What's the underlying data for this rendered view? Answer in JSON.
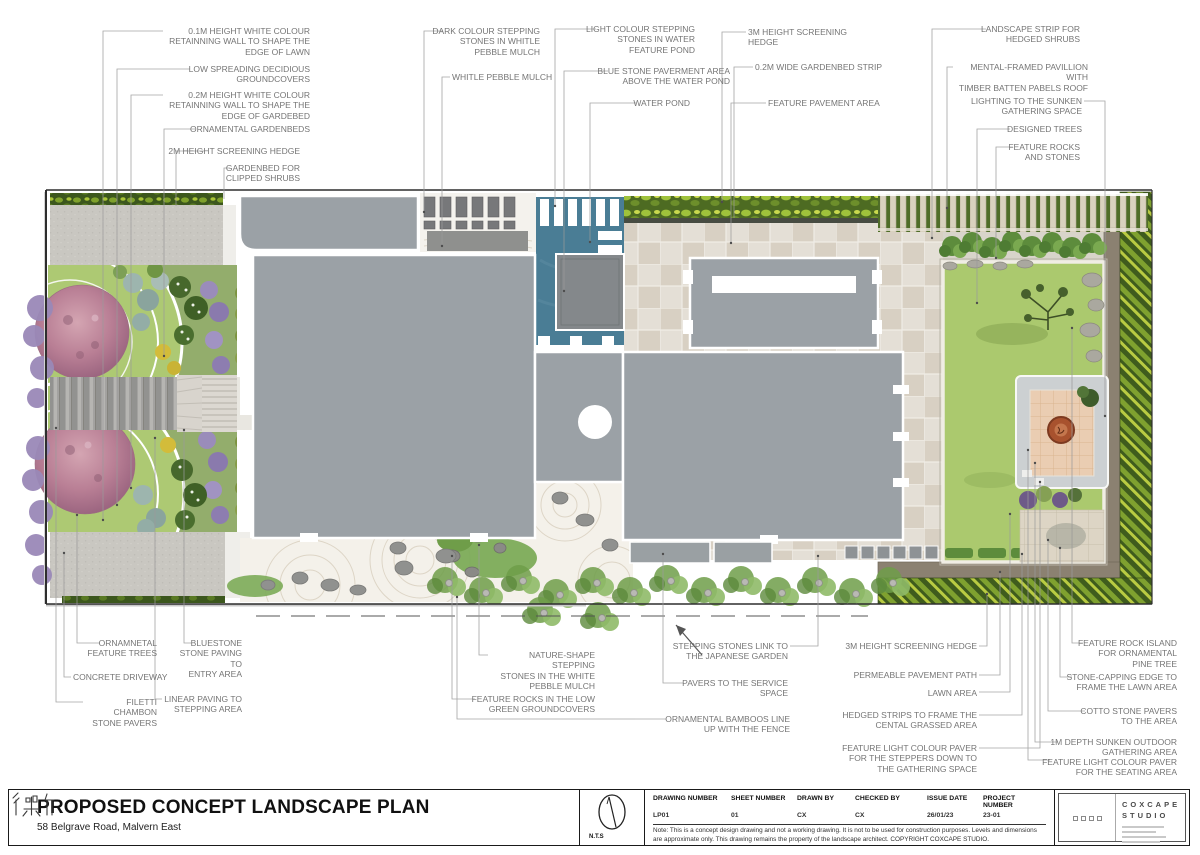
{
  "callouts": {
    "c1": {
      "text": "0.1M HEIGHT WHITE COLOUR\nRETAINNING WALL TO SHAPE THE\nEDGE OF LAWN"
    },
    "c2": {
      "text": "LOW SPREADING DECIDIOUS\nGROUNDCOVERS"
    },
    "c3": {
      "text": "0.2M HEIGHT WHITE COLOUR\nRETAINNING WALL TO SHAPE THE\nEDGE OF GARDEBED"
    },
    "c4": {
      "text": "ORNAMENTAL GARDENBEDS"
    },
    "c5": {
      "text": "2M HEIGHT SCREENING HEDGE"
    },
    "c6": {
      "text": "GARDENBED FOR\nCLIPPED SHRUBS"
    },
    "c7": {
      "text": "DARK COLOUR STEPPING\nSTONES IN WHITLE\nPEBBLE MULCH"
    },
    "c8": {
      "text": "WHITLE PEBBLE MULCH"
    },
    "c9": {
      "text": "LIGHT COLOUR STEPPING\nSTONES IN WATER\nFEATURE POND"
    },
    "c10": {
      "text": "BLUE STONE PAVERMENT AREA\nABOVE THE WATER POND"
    },
    "c11": {
      "text": "WATER POND"
    },
    "c12": {
      "text": "3M HEIGHT SCREENING HEDGE"
    },
    "c13": {
      "text": "0.2M WIDE GARDENBED STRIP"
    },
    "c14": {
      "text": "FEATURE PAVEMENT AREA"
    },
    "c15": {
      "text": "LANDSCAPE STRIP FOR\nHEDGED SHRUBS"
    },
    "c16": {
      "text": "MENTAL-FRAMED PAVILLION WITH\nTIMBER BATTEN PABELS ROOF"
    },
    "c17": {
      "text": "LIGHTING TO THE SUNKEN\nGATHERING SPACE"
    },
    "c18": {
      "text": "DESIGNED TREES"
    },
    "c19": {
      "text": "FEATURE ROCKS\nAND STONES"
    },
    "c20": {
      "text": "ORNAMNETAL\nFEATURE TREES"
    },
    "c21": {
      "text": "CONCRETE DRIVEWAY"
    },
    "c22": {
      "text": "FILETTI CHAMBON\nSTONE PAVERS"
    },
    "c23": {
      "text": "BLUESTONE\nSTONE PAVING TO\nENTRY AREA"
    },
    "c24": {
      "text": "LINEAR PAVING TO\nSTEPPING AREA"
    },
    "c25": {
      "text": "NATURE-SHAPE STEPPING\nSTONES IN THE WHITE\nPEBBLE MULCH"
    },
    "c26": {
      "text": "FEATURE ROCKS IN THE LOW\nGREEN GROUNDCOVERS"
    },
    "c27": {
      "text": "STEPPING STONES LINK TO\nTHE JAPANESE GARDEN"
    },
    "c28": {
      "text": "PAVERS TO THE SERVICE\nSPACE"
    },
    "c29": {
      "text": "ORNAMENTAL BAMBOOS LINE\nUP WITH THE FENCE"
    },
    "c30": {
      "text": "3M HEIGHT SCREENING HEDGE"
    },
    "c31": {
      "text": "PERMEABLE PAVEMENT PATH"
    },
    "c32": {
      "text": "LAWN AREA"
    },
    "c33": {
      "text": "HEDGED STRIPS TO FRAME THE\nCENTAL GRASSED AREA"
    },
    "c34": {
      "text": "FEATURE LIGHT COLOUR PAVER\nFOR THE STEPPERS DOWN TO\nTHE GATHERING SPACE"
    },
    "c35": {
      "text": "FEATURE ROCK ISLAND\nFOR ORNAMENTAL\nPINE TREE"
    },
    "c36": {
      "text": "STONE-CAPPING EDGE TO\nFRAME THE LAWN AREA"
    },
    "c37": {
      "text": "COTTO STONE PAVERS\nTO THE AREA"
    },
    "c38": {
      "text": "1M DEPTH SUNKEN OUTDOOR\nGATHERING AREA"
    },
    "c39": {
      "text": "FEATURE LIGHT COLOUR PAVER\nFOR THE SEATING AREA"
    }
  },
  "title_block": {
    "title": "PROPOSED CONCEPT LANDSCAPE PLAN",
    "address": "58 Belgrave Road, Malvern East",
    "scale_label": "N.T.S",
    "fields": [
      {
        "label": "DRAWING NUMBER",
        "value": "LP01"
      },
      {
        "label": "SHEET NUMBER",
        "value": "01"
      },
      {
        "label": "DRAWN BY",
        "value": "CX"
      },
      {
        "label": "CHECKED BY",
        "value": "CX"
      },
      {
        "label": "ISSUE DATE",
        "value": "26/01/23"
      },
      {
        "label": "PROJECT NUMBER",
        "value": "23-01"
      }
    ],
    "note": "Note: This is a concept design drawing and not a working drawing. It is not to be used for construction purposes. Levels and dimensions are approximate only. This drawing remains the property of the landscape architect. COPYRIGHT COXCAPE STUDIO.",
    "logo": {
      "name_line1": "COXCAPE",
      "name_line2": "STUDIO"
    }
  },
  "colors": {
    "pond_blue": "#4a7d95",
    "house_gray": "#9ba1a6",
    "lawn_green": "#abc96e",
    "hedge_dark_green": "#3c571d",
    "pavement_beige": "#e4dfd6",
    "firepit_rust": "#a8522e"
  }
}
